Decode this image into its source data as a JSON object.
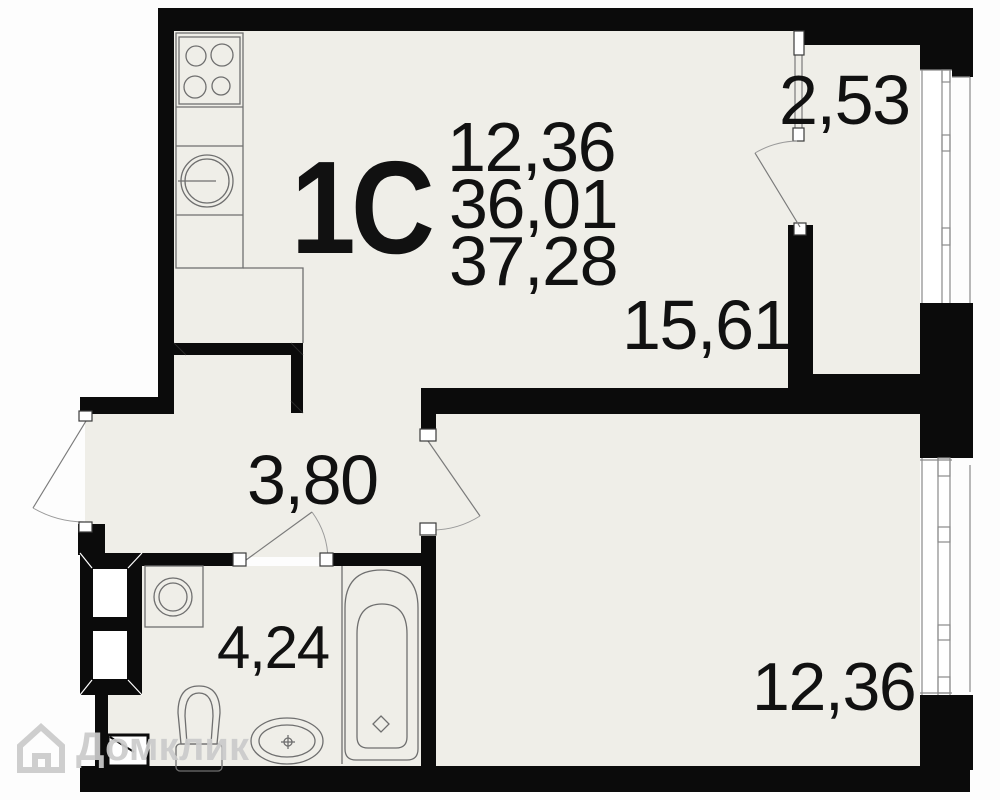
{
  "plan": {
    "unit_label": "1C",
    "stats": {
      "kitchen_living_area": "12,36",
      "total_area": "36,01",
      "total_area_with_balcony": "37,28"
    },
    "rooms": {
      "balcony": "2,53",
      "living": "15,61",
      "hall": "3,80",
      "bathroom": "4,24",
      "bedroom": "12,36"
    },
    "watermark": {
      "brand": "Домклик"
    },
    "colors": {
      "wall": "#0b0b0b",
      "floor": "#efeee8",
      "fixture_outline": "#6f6f6f",
      "door_line": "#7a7a7a",
      "watermark": "#cbcbcb"
    }
  }
}
